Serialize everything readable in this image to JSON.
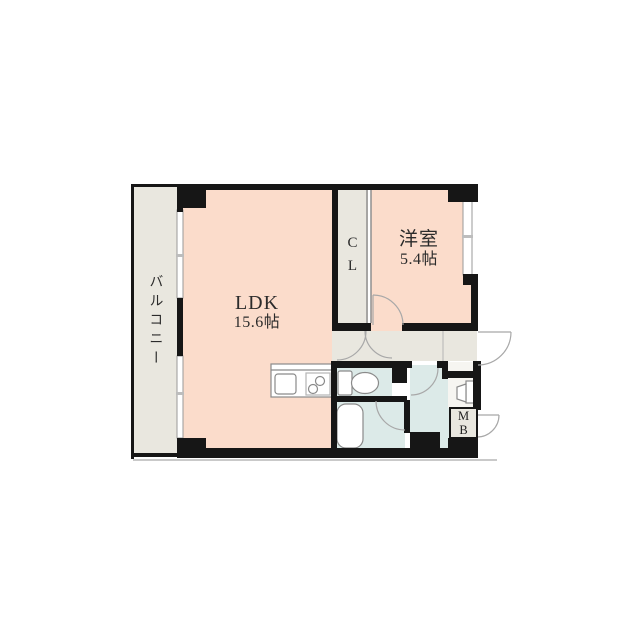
{
  "floorplan": {
    "labels": {
      "balcony": "バルコニー",
      "ldk_name": "LDK",
      "ldk_area": "15.6帖",
      "closet_line1": "C",
      "closet_line2": "L",
      "bedroom_name": "洋室",
      "bedroom_area": "5.4帖",
      "meter_box_line1": "M",
      "meter_box_line2": "B"
    },
    "colors": {
      "room_pink": "#fbdccb",
      "service_gray": "#e9e7df",
      "wet_blue": "#dceae8",
      "wall_black": "#161616",
      "window_line": "#9a9a9a",
      "door_arc_gray": "#a8a8a8",
      "fixture_gray": "#8a8a8a",
      "shadow_gray": "#c9c9c9",
      "meter_box_fill": "#e9e7df"
    }
  }
}
